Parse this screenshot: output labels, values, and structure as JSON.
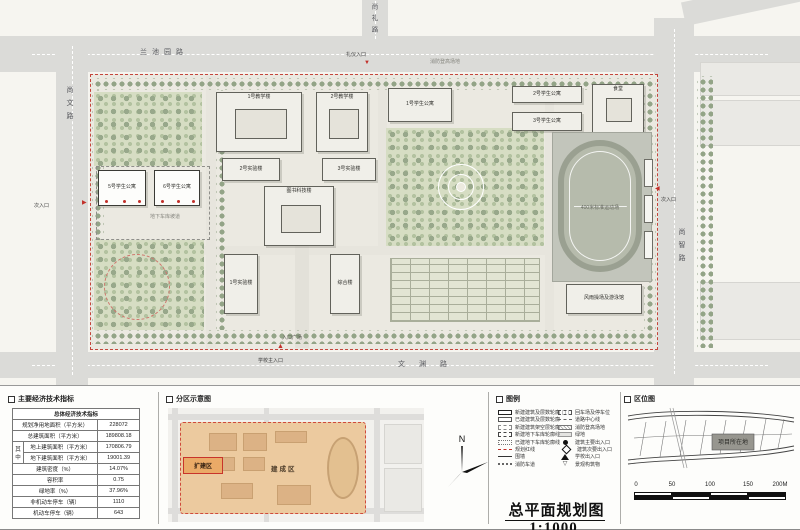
{
  "title": "总平面规划图 1:1000",
  "plan": {
    "roads": {
      "top": "兰池园路",
      "top_right": "尚礼路",
      "left": "尚文路",
      "right": "尚智路",
      "bottom": "文渊路"
    },
    "entrances": {
      "ceremony": "礼仪入口",
      "main": "学校主入口",
      "side_right": "次入口",
      "side_left": "次入口"
    },
    "notes": {
      "plaza": "入口广场",
      "fire": "消防登高场地",
      "ramp": "地下车库坡道"
    },
    "buildings": {
      "b1": "1号教学楼",
      "b2": "2号教学楼",
      "b3": "1号学生公寓",
      "b4": "2号学生公寓",
      "b5": "3号学生公寓",
      "b6": "食堂",
      "b7": "2号实验楼",
      "b8": "3号实验楼",
      "b9": "图书科技楼",
      "b10": "1号实验楼",
      "b11": "综合楼",
      "b12": "5号学生公寓",
      "b13": "6号学生公寓",
      "b14": "风雨操场及游泳馆",
      "stadium": "400米标准运动场"
    }
  },
  "econ": {
    "header": "主要经济技术指标",
    "table_title": "总体经济技术指标",
    "among": "其中",
    "rows": [
      {
        "label": "规划净用地面积（平方米）",
        "value": "228072"
      },
      {
        "label": "总建筑面积（平方米）",
        "value": "189808.18"
      },
      {
        "label": "地上建筑面积（平方米）",
        "value": "170806.79"
      },
      {
        "label": "地下建筑面积（平方米）",
        "value": "19001.39"
      },
      {
        "label": "建筑密度（%）",
        "value": "14.07%"
      },
      {
        "label": "容积率",
        "value": "0.75"
      },
      {
        "label": "绿地率（%）",
        "value": "37.96%"
      },
      {
        "label": "非机动车停车（辆）",
        "value": "1110"
      },
      {
        "label": "机动车停车（辆）",
        "value": "643"
      }
    ]
  },
  "zoning": {
    "header": "分区示意图",
    "expansion": "扩建区",
    "built": "建成区"
  },
  "north": {
    "label": "N"
  },
  "legend": {
    "header": "图例",
    "left": [
      "新建建筑及层数轮廓",
      "已建建筑及层数轮廓",
      "新建建筑架空层轮廓",
      "新建地下车库轮廓线",
      "已建地下车库轮廓线",
      "规划红线",
      "围墙",
      "消防车道"
    ],
    "right": [
      "回车场及停车位",
      "道路中心线",
      "消防登高场地",
      "绿地",
      "建筑主要出入口",
      "建筑次要出入口",
      "学校出入口",
      "景观构筑物"
    ]
  },
  "location": {
    "header": "区位图",
    "site": "项目所在地",
    "ticks": [
      "0",
      "50",
      "100",
      "150",
      "200M"
    ]
  },
  "colors": {
    "red_line": "#c4453b",
    "expansion_fill": "#eaaa67",
    "tree_green": "#93a487"
  }
}
